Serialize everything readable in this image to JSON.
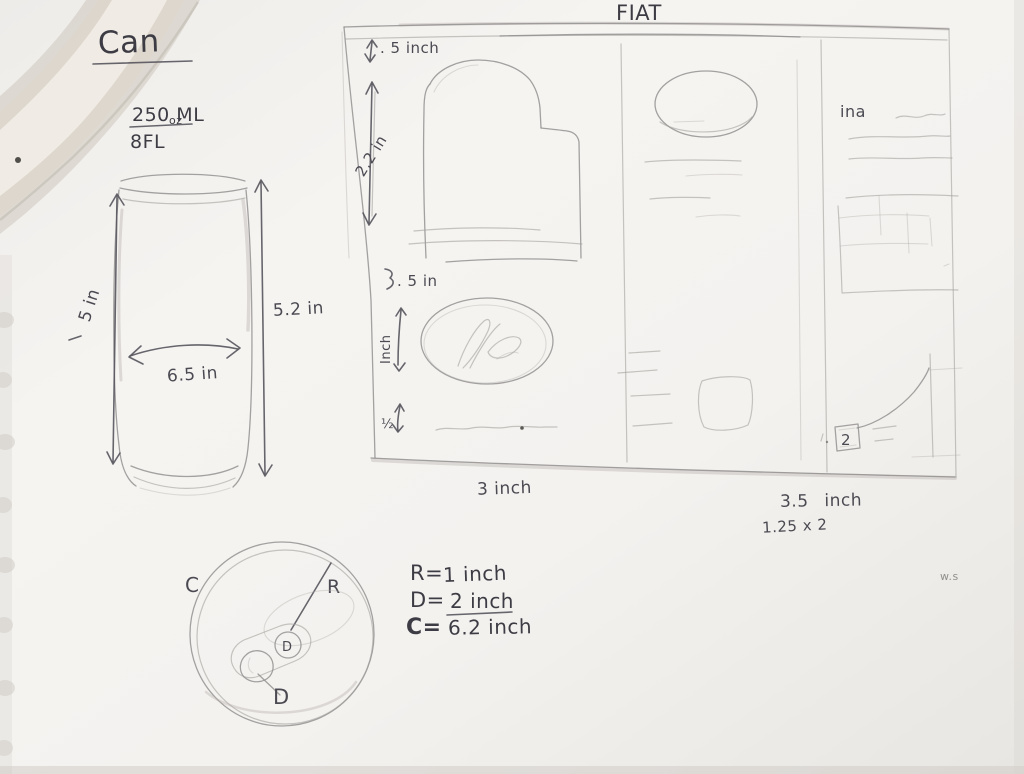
{
  "can": {
    "title": "Can",
    "volume": {
      "numerator": "250 ML",
      "denominator": "8FL",
      "unit_sup": "oz"
    },
    "front_view": {
      "left_height": "5 in",
      "right_height": "5.2 in",
      "width": "6.5 in"
    },
    "top_view": {
      "circumference_label": "C",
      "radius_label": "R",
      "tab_label": "D",
      "diameter_label": "D"
    },
    "equations": {
      "radius_lhs": "R=",
      "radius_rhs": "1 inch",
      "diameter_lhs": "D=",
      "diameter_rhs": "2 inch",
      "circumference_lhs": "C=",
      "circumference_rhs": "6.2 inch"
    }
  },
  "fiat": {
    "title": "FIAT",
    "left_measurements": {
      "header_height": ". 5 inch",
      "hero_height": "2.2 in",
      "gap_height": ". 5 in",
      "logo_height": "Inch",
      "small_height": "½"
    },
    "bottom_measurements": {
      "left_width": "3 inch",
      "right_width": "3.5 inch",
      "note": "1.25 x 2"
    },
    "right_panel": {
      "label": "ina",
      "page_box": "2"
    },
    "faint_note": "w.s"
  }
}
